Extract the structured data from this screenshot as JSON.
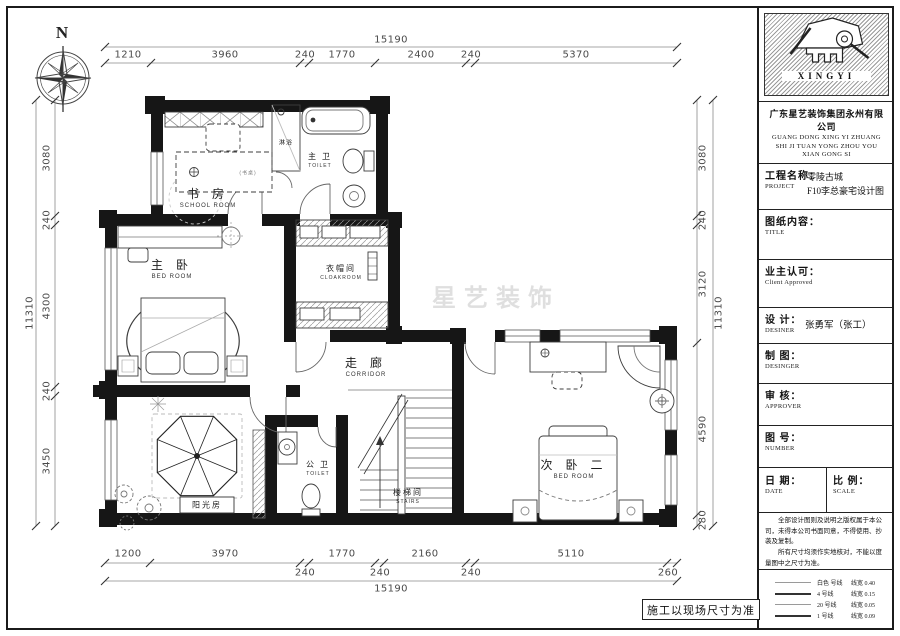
{
  "compass": {
    "north": "N"
  },
  "watermark": "星艺装饰",
  "site_note": "施工以现场尺寸为准",
  "rooms": {
    "study": {
      "cn": "书 房",
      "en": "SCHOOL ROOM",
      "desk_note": "(书桌)"
    },
    "shower": {
      "cn": "淋浴"
    },
    "master_toilet": {
      "cn": "主 卫",
      "en": "TOILET"
    },
    "master_bed": {
      "cn": "主 卧",
      "en": "BED ROOM"
    },
    "cloakroom": {
      "cn": "衣帽间",
      "en": "CLOAKROOM"
    },
    "corridor": {
      "cn": "走 廊",
      "en": "CORRIDOR"
    },
    "bed2": {
      "cn": "次 卧 二",
      "en": "BED ROOM"
    },
    "sunroom": {
      "cn": "阳光房"
    },
    "public_toilet": {
      "cn": "公 卫",
      "en": "TOILET"
    },
    "stairs": {
      "cn": "楼梯间",
      "en": "STAIRS"
    }
  },
  "dims": {
    "top": {
      "total": "15190",
      "segs": [
        "1210",
        "3960",
        "240",
        "1770",
        "2400",
        "240",
        "5370"
      ]
    },
    "bottom": {
      "total": "15190",
      "segs": [
        "1200",
        "3970",
        "240",
        "1770",
        "240",
        "2160",
        "240",
        "5110",
        "260"
      ]
    },
    "left": {
      "total": "11310",
      "segs": [
        "3080",
        "240",
        "4300",
        "240",
        "3450"
      ]
    },
    "right": {
      "total": "11310",
      "segs": [
        "3080",
        "240",
        "3120",
        "4590",
        "280"
      ]
    }
  },
  "title_block": {
    "logo_text": "XINGYI",
    "company_cn": "广东星艺装饰集团永州有限公司",
    "company_en1": "GUANG DONG XING YI ZHUANG",
    "company_en2": "SHI JI TUAN YONG ZHOU YOU",
    "company_en3": "XIAN GONG SI",
    "project_label": "工程名称：",
    "project_sub": "PROJECT",
    "project_value1": "零陵古城",
    "project_value2": "F10李总豪宅设计图",
    "content_label": "图纸内容：",
    "content_sub": "TITLE",
    "client_label": "业主认可：",
    "client_sub": "Client Approved",
    "design_label": "设 计：",
    "design_sub": "DESINER",
    "design_value": "张勇军（张工）",
    "draft_label": "制 图：",
    "draft_sub": "DESINGER",
    "review_label": "审 核：",
    "review_sub": "APPROVER",
    "number_label": "图 号：",
    "number_sub": "NUMBER",
    "date_label": "日 期：",
    "date_sub": "DATE",
    "scale_label": "比 例：",
    "scale_sub": "SCALE",
    "note1": "全部设计图则及说明之版权属于本公司，未得本公司书面同意，不得使用、抄袭及复制。",
    "note2": "所有尺寸均须作实地核对，不能以度量图中之尺寸为准。",
    "legend": [
      {
        "name": "白色 号线",
        "width": "线宽 0.40"
      },
      {
        "name": "4 号线",
        "width": "线宽 0.15"
      },
      {
        "name": "20 号线",
        "width": "线宽 0.05"
      },
      {
        "name": "1 号线",
        "width": "线宽 0.09"
      }
    ]
  }
}
